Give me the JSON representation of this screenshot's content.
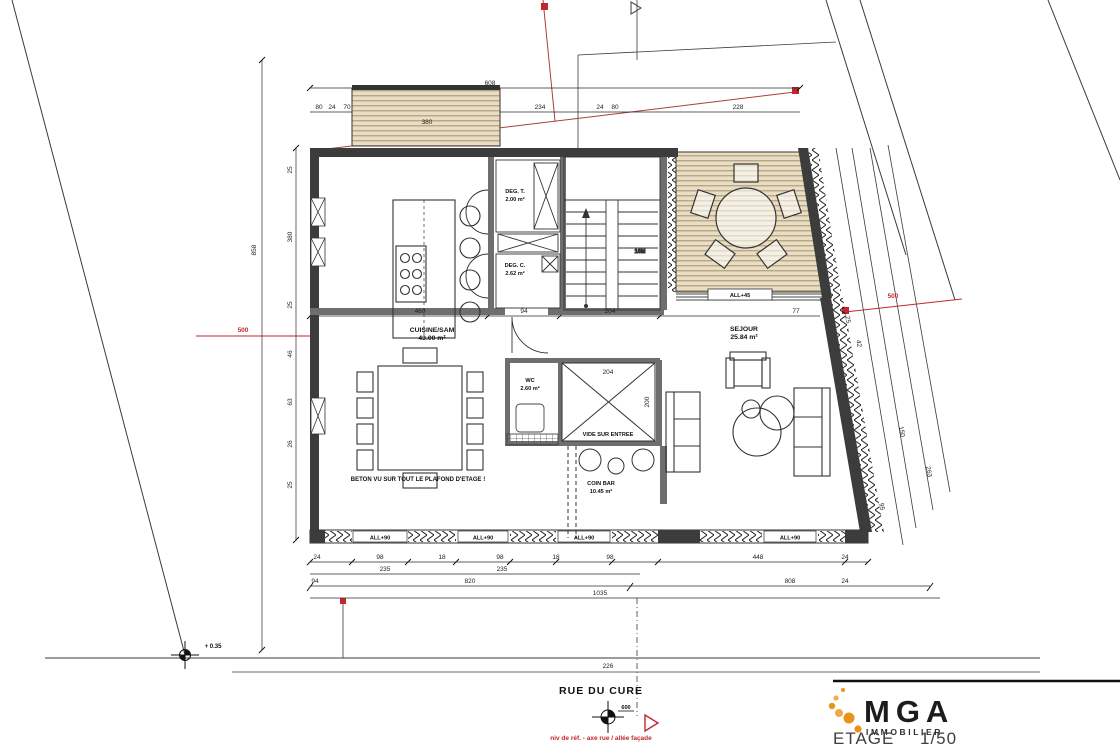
{
  "drawing": {
    "street_label": "RUE DU CURE",
    "level_value": "600",
    "red_note": "niv de réf. - axe rue / allée façade",
    "survey_point": "+ 0.35",
    "note_ceiling": "BETON VU SUR TOUT LE PLAFOND D'ETAGE !",
    "rooms": {
      "cuisine": {
        "label": "CUISINE/SAM",
        "area": "43.00 m²"
      },
      "sejour": {
        "label": "SEJOUR",
        "area": "25.84 m²"
      },
      "deg_t": {
        "label": "DEG. T.",
        "area": "2.00 m²"
      },
      "deg_c": {
        "label": "DEG. C.",
        "area": "2.62 m²"
      },
      "wc": {
        "label": "WC",
        "area": "2.60 m²"
      },
      "coin_bar": {
        "label": "COIN BAR",
        "area": "10.45 m²"
      },
      "vide": {
        "label": "VIDE SUR ENTREE"
      },
      "stairs": {
        "label": "16M"
      }
    },
    "window_labels": [
      "ALL+90",
      "ALL+90",
      "ALL+90",
      "ALL+90"
    ],
    "terrace_label": "ALL+45",
    "dimensions": [
      {
        "t": "380",
        "x": 427,
        "y": 124
      },
      {
        "t": "608",
        "x": 490,
        "y": 85
      },
      {
        "t": "80",
        "x": 319,
        "y": 109
      },
      {
        "t": "24",
        "x": 332,
        "y": 109
      },
      {
        "t": "70",
        "x": 347,
        "y": 109
      },
      {
        "t": "234",
        "x": 540,
        "y": 109
      },
      {
        "t": "24",
        "x": 600,
        "y": 109
      },
      {
        "t": "80",
        "x": 615,
        "y": 109
      },
      {
        "t": "228",
        "x": 738,
        "y": 109
      },
      {
        "t": "500",
        "x": 243,
        "y": 332,
        "c": "red"
      },
      {
        "t": "500",
        "x": 893,
        "y": 298,
        "c": "red"
      },
      {
        "t": "858",
        "x": 256,
        "y": 250,
        "r": -90
      },
      {
        "t": "25",
        "x": 292,
        "y": 170,
        "r": -90
      },
      {
        "t": "380",
        "x": 292,
        "y": 237,
        "r": -90
      },
      {
        "t": "25",
        "x": 292,
        "y": 305,
        "r": -90
      },
      {
        "t": "46",
        "x": 292,
        "y": 354,
        "r": -90
      },
      {
        "t": "63",
        "x": 292,
        "y": 402,
        "r": -90
      },
      {
        "t": "26",
        "x": 292,
        "y": 444,
        "r": -90
      },
      {
        "t": "25",
        "x": 292,
        "y": 485,
        "r": -90
      },
      {
        "t": "460",
        "x": 420,
        "y": 313
      },
      {
        "t": "94",
        "x": 524,
        "y": 313
      },
      {
        "t": "204",
        "x": 610,
        "y": 313
      },
      {
        "t": "77",
        "x": 796,
        "y": 313
      },
      {
        "t": "204",
        "x": 608,
        "y": 374
      },
      {
        "t": "200",
        "x": 649,
        "y": 402,
        "r": -90
      },
      {
        "t": "24",
        "x": 317,
        "y": 559
      },
      {
        "t": "98",
        "x": 380,
        "y": 559
      },
      {
        "t": "18",
        "x": 442,
        "y": 559
      },
      {
        "t": "98",
        "x": 500,
        "y": 559
      },
      {
        "t": "18",
        "x": 556,
        "y": 559
      },
      {
        "t": "98",
        "x": 610,
        "y": 559
      },
      {
        "t": "448",
        "x": 758,
        "y": 559
      },
      {
        "t": "24",
        "x": 845,
        "y": 559
      },
      {
        "t": "235",
        "x": 385,
        "y": 571
      },
      {
        "t": "235",
        "x": 502,
        "y": 571
      },
      {
        "t": "94",
        "x": 315,
        "y": 583
      },
      {
        "t": "820",
        "x": 470,
        "y": 583
      },
      {
        "t": "808",
        "x": 790,
        "y": 583
      },
      {
        "t": "24",
        "x": 845,
        "y": 583
      },
      {
        "t": "1035",
        "x": 600,
        "y": 595
      },
      {
        "t": "226",
        "x": 608,
        "y": 668
      },
      {
        "t": "25",
        "x": 846,
        "y": 320,
        "r": 80
      },
      {
        "t": "42",
        "x": 857,
        "y": 344,
        "r": 80
      },
      {
        "t": "150",
        "x": 900,
        "y": 432,
        "r": 80
      },
      {
        "t": "263",
        "x": 927,
        "y": 472,
        "r": 80
      },
      {
        "t": "95",
        "x": 880,
        "y": 507,
        "r": 80
      }
    ],
    "colors": {
      "accent_red": "#c2272d",
      "wood": "#e9ddc4",
      "wood_line": "#a5906c",
      "wall_dark": "#3c3c3c",
      "wall_light": "#777777",
      "logo_orange": "#e8941a",
      "line": "#1a1a1a"
    }
  },
  "footer": {
    "brand": "MGA",
    "brand_sub": "IMMOBILIER",
    "sheet_name": "ETAGE",
    "sheet_scale": "1/50"
  }
}
